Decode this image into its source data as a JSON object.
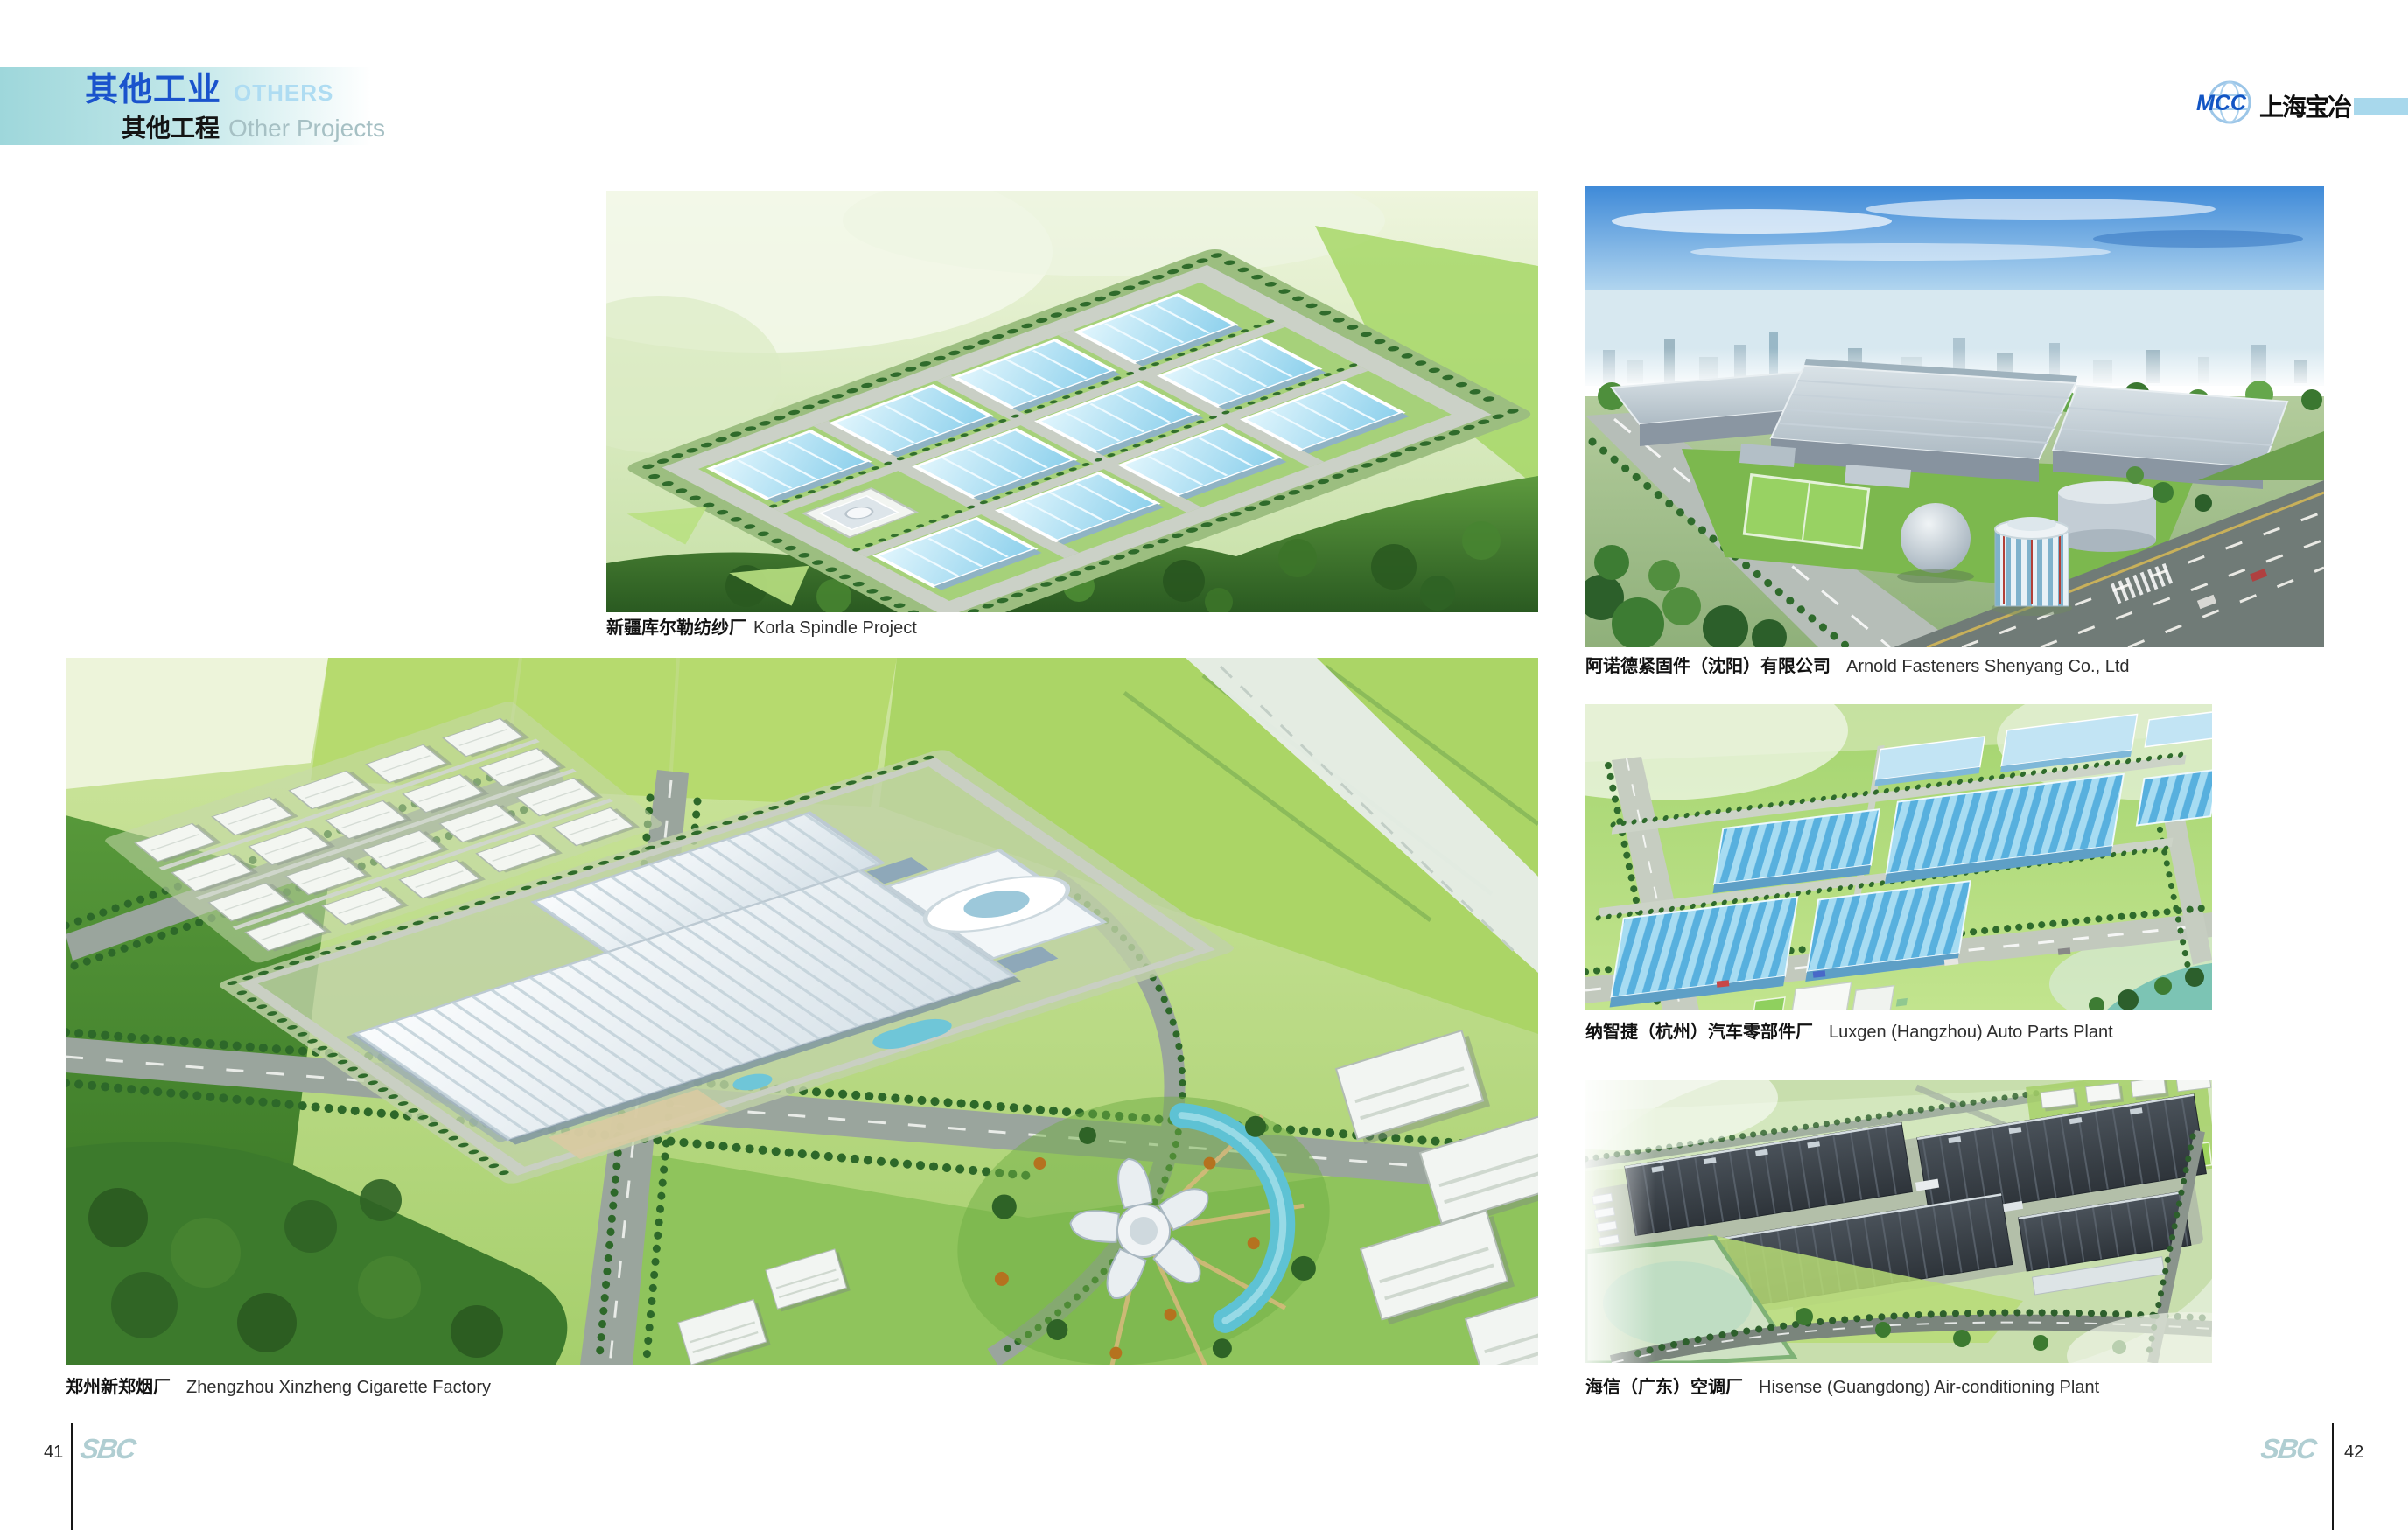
{
  "header": {
    "title_zh": "其他工业",
    "title_en": "OTHERS",
    "subtitle_zh": "其他工程",
    "subtitle_en": "Other Projects"
  },
  "brand": {
    "logo_text": "MCC",
    "company_zh": "上海宝冶"
  },
  "figures": [
    {
      "caption_zh": "新疆库尔勒纺纱厂",
      "caption_en": "Korla Spindle Project"
    },
    {
      "caption_zh": "阿诺德紧固件（沈阳）有限公司",
      "caption_en": "Arnold Fasteners Shenyang Co., Ltd"
    },
    {
      "caption_zh": "纳智捷（杭州）汽车零部件厂",
      "caption_en": "Luxgen (Hangzhou) Auto Parts Plant"
    },
    {
      "caption_zh": "郑州新郑烟厂",
      "caption_en": "Zhengzhou Xinzheng Cigarette Factory"
    },
    {
      "caption_zh": "海信（广东）空调厂",
      "caption_en": "Hisense (Guangdong) Air-conditioning Plant"
    }
  ],
  "footer": {
    "page_number_left": "41",
    "page_number_right": "42",
    "watermark": "SBC"
  },
  "colors": {
    "title_blue": "#1a53cc",
    "title_light_blue": "#aedcf2",
    "subtitle_gray": "#a6c0c4",
    "header_bar_cyan": "#9ed7db",
    "brand_blue": "#1255c4",
    "brand_bar_blue": "#a8d8ec",
    "watermark_teal": "#b0ced2"
  }
}
